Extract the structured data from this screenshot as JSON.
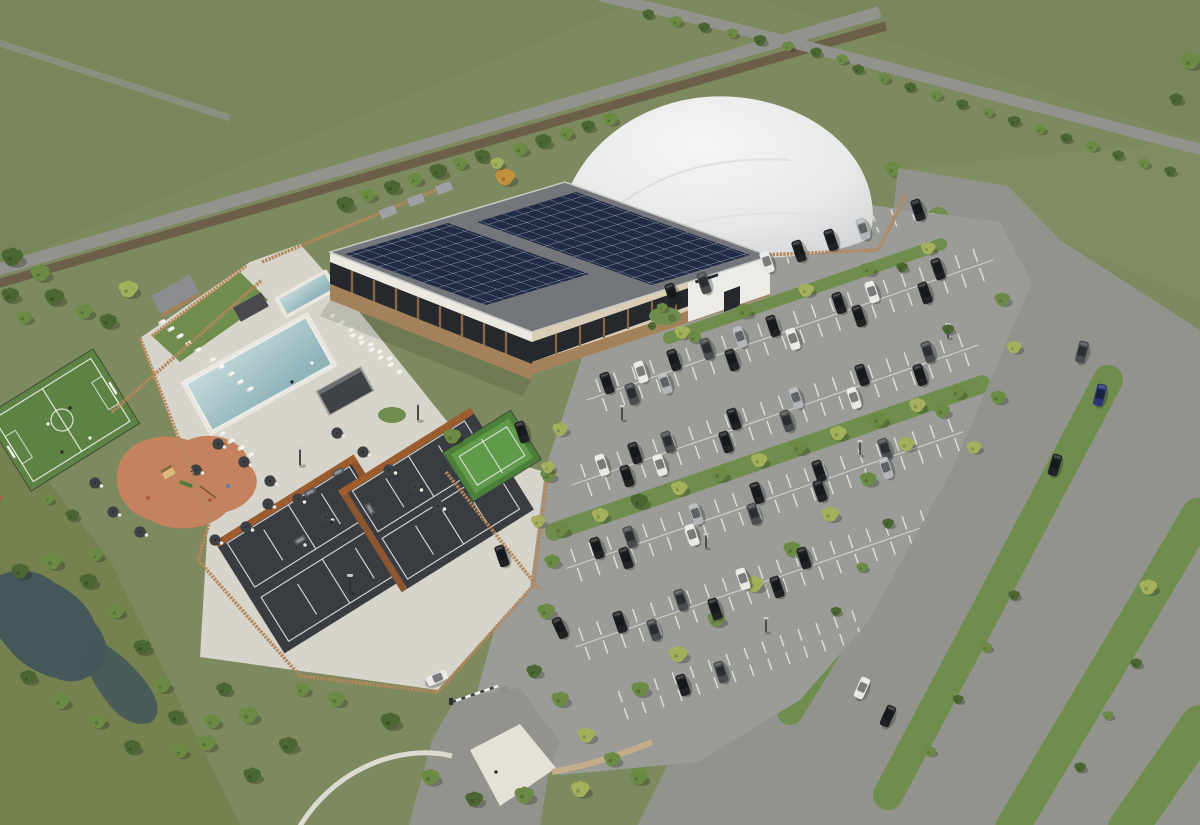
{
  "scene": {
    "description": "Aerial architectural rendering of a racquets and fitness club campus: a clubhouse with two rooftop solar arrays, a white air-supported sports dome behind it, an outdoor pool lined with sun loungers, a small spa pool enclosure, four dark tennis courts with orange windbreaks, one green mini court, a fenced five-a-side pitch, a terracotta playground, a cafe terrace with dark parasols, a large tree-lined car park full of cars, an estate road with grass verges and a footpath, a pond with scrub planting, and open green fields with hedged lanes beyond."
  },
  "features": {
    "clubhouse_solar_arrays": 2,
    "air_dome": 1,
    "outdoor_pools": 2,
    "tennis_courts": 4,
    "mini_tennis_courts": 1,
    "five_a_side_pitch": 1,
    "playground": 1,
    "car_park_bay_rows": 6,
    "entrance_barrier": 1,
    "pond": 1
  },
  "palette": {
    "field": "#7d895e",
    "fieldDark": "#707c52",
    "grassBright": "#6f8e4e",
    "roadGray": "#93938d",
    "trackBrown": "#6b5f49",
    "asphalt": "#9b9b97",
    "roofGray": "#73767a",
    "solarNavy": "#222a45",
    "facade": "#d9cdb5",
    "fasciaWhite": "#eae8e1",
    "glass": "#25282c",
    "wood": "#8a6743",
    "woodBase": "#a3815a",
    "fenceWood": "#b5875a",
    "fenceOrange": "#a85f2c",
    "poolHi": "#c4d9da",
    "poolLo": "#8fb4ba",
    "deck": "#d7d5cb",
    "deckBright": "#e3e1d8",
    "courtDark": "#393c40",
    "courtLine": "#dfe1e3",
    "courtGreen": "#5f9b48",
    "courtGreenDk": "#4b7f3a",
    "pitchGreen": "#5c8343",
    "playTerra": "#c4825f",
    "treeDark": "#4a6632",
    "treeMid": "#6b8b44",
    "treeLight": "#a4b05c",
    "treeAutumn": "#c1913e",
    "pond": "#44585a",
    "pathTan": "#c3ae89",
    "pathWhite": "#dcdad1",
    "domeHi": "#f5f5f4",
    "domeLo": "#cfd0d3",
    "carDark": "#202225",
    "carGray": "#4a4d50",
    "carWhite": "#e8e8e6",
    "carSilver": "#b3b6b8",
    "carBlue": "#2b3570",
    "shadow": "rgba(25,30,22,0.28)"
  }
}
